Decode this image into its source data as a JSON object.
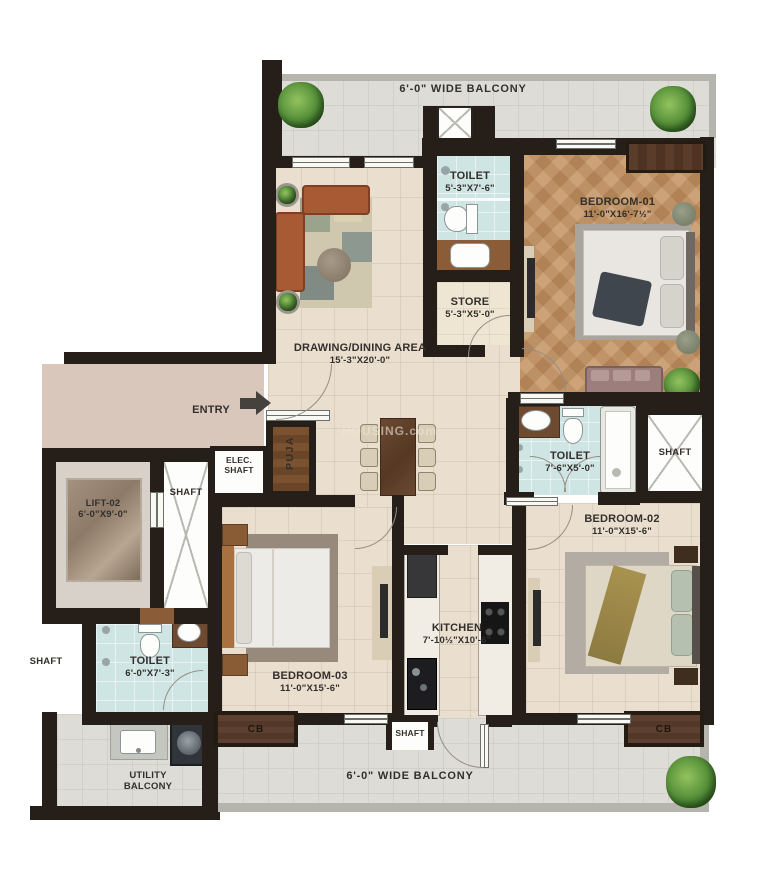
{
  "watermark": "HOUSING.com",
  "balconies": {
    "top_label": "6'-0\" WIDE BALCONY",
    "bottom_label": "6'-0\" WIDE BALCONY",
    "utility_line1": "UTILITY",
    "utility_line2": "BALCONY"
  },
  "rooms": {
    "drawing_dining": {
      "name": "DRAWING/DINING AREA",
      "dims": "15'-3\"X20'-0\""
    },
    "bedroom_01": {
      "name": "BEDROOM-01",
      "dims": "11'-0\"X16'-7½\""
    },
    "bedroom_02": {
      "name": "BEDROOM-02",
      "dims": "11'-0\"X15'-6\""
    },
    "bedroom_03": {
      "name": "BEDROOM-03",
      "dims": "11'-0\"X15'-6\""
    },
    "kitchen": {
      "name": "KITCHEN",
      "dims": "7'-10½\"X10'-6\""
    },
    "toilet_top": {
      "name": "TOILET",
      "dims": "5'-3\"X7'-6\""
    },
    "toilet_mid": {
      "name": "TOILET",
      "dims": "7'-6\"X5'-0\""
    },
    "toilet_bottom": {
      "name": "TOILET",
      "dims": "6'-0\"X7'-3\""
    },
    "store": {
      "name": "STORE",
      "dims": "5'-3\"X5'-0\""
    },
    "puja": {
      "name": "PUJA"
    },
    "lift": {
      "name": "LIFT-02",
      "dims": "6'-0\"X9'-0\""
    }
  },
  "entry": {
    "label": "ENTRY"
  },
  "shafts": {
    "beside_lift": "SHAFT",
    "elec_line1": "ELEC.",
    "elec_line2": "SHAFT",
    "right": "SHAFT",
    "west": "SHAFT",
    "kitchen": "SHAFT"
  },
  "closets": {
    "cb_bedroom_03": "CB",
    "cb_bedroom_02": "CB"
  },
  "colors": {
    "wall": "#261f19",
    "floor_beige": "#eadece",
    "floor_gray": "#dddcd6",
    "floor_toilet": "#cfe5e3",
    "floor_wood": "#c29367",
    "floor_corridor": "#d8c7ba",
    "sofa": "#a85a34",
    "accent_wood": "#5d4030"
  }
}
